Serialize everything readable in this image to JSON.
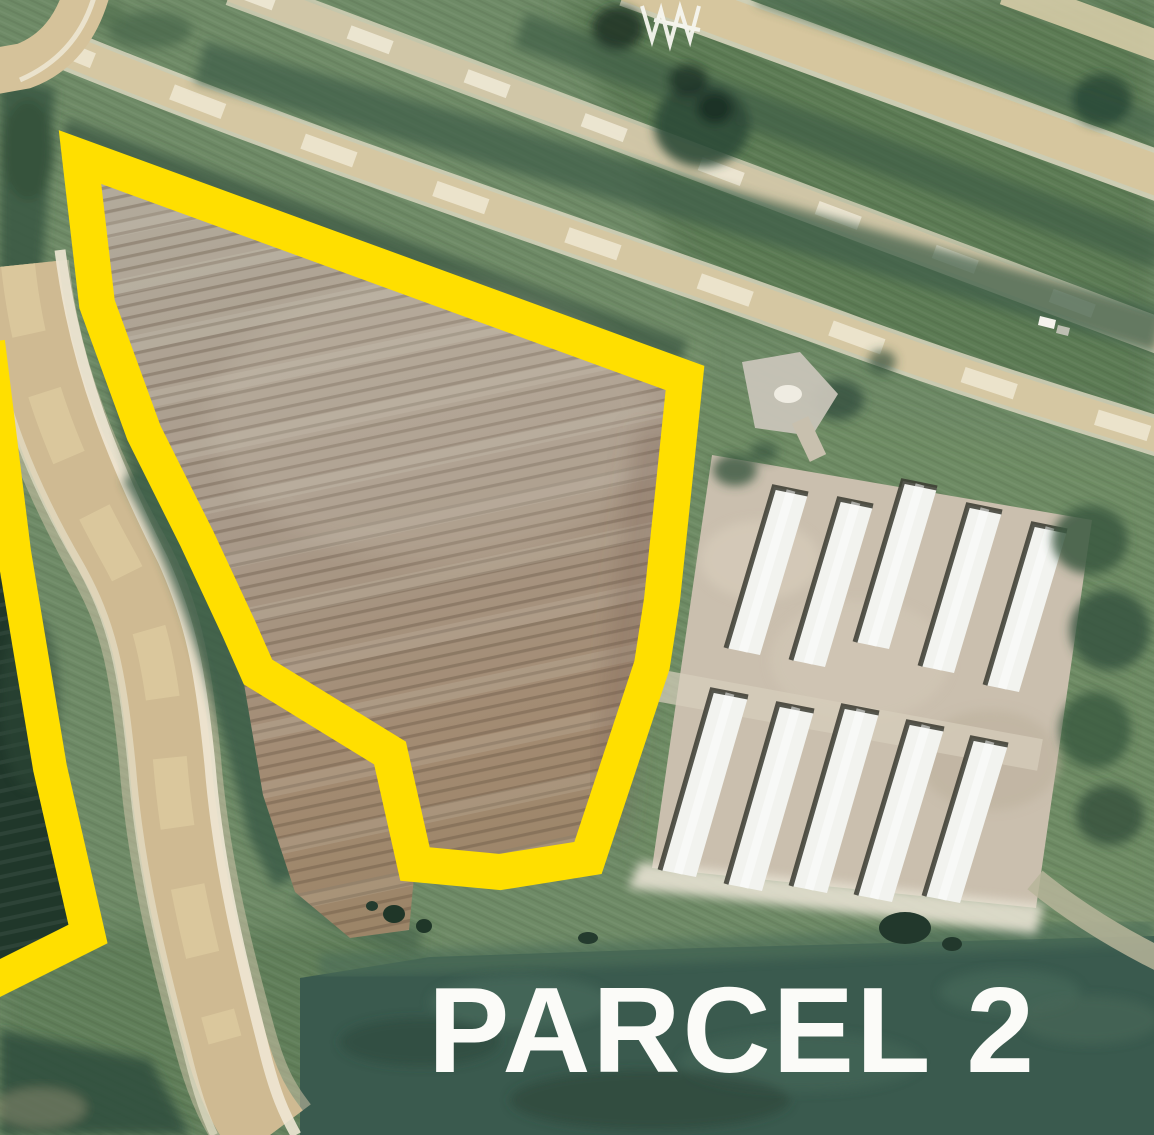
{
  "map": {
    "kind": "aerial-parcel-annotation",
    "parcel_label": "PARCEL 2",
    "annotation_color": "#ffdf00",
    "label_color": "#fbfbf8",
    "scene": {
      "highlighted_parcel": "plowed field outlined in thick yellow with notched south boundary",
      "adjacent_parcel": "second yellow-outlined parcel clipped at left edge with dark crop field",
      "barn_complex": "two rows of five long white barns on tan gravel pad",
      "roads": "tan dirt roads crossing diagonally at top and curving along left side"
    }
  }
}
